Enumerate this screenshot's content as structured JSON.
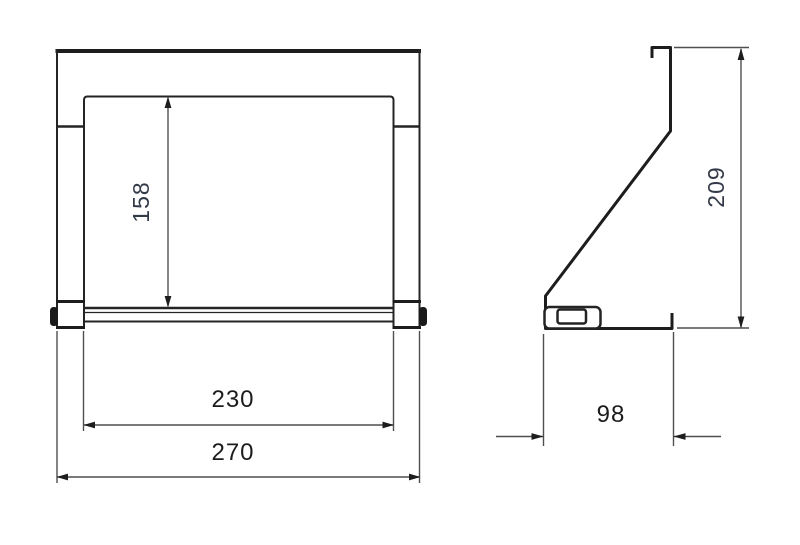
{
  "drawing": {
    "kind": "technical-dimension-drawing",
    "background_color": "#ffffff",
    "part_line_color": "#242424",
    "dimension_line_color": "#4f4f4f",
    "label_color": "#1c1c1c",
    "rotated_label_color": "#333a48",
    "front_view": {
      "name": "front view",
      "dimensions": {
        "opening_height": {
          "value": "158",
          "orientation": "vertical"
        },
        "opening_width": {
          "value": "230",
          "orientation": "horizontal"
        },
        "overall_width": {
          "value": "270",
          "orientation": "horizontal"
        }
      }
    },
    "side_view": {
      "name": "side view",
      "dimensions": {
        "overall_height": {
          "value": "209",
          "orientation": "vertical"
        },
        "base_depth": {
          "value": "98",
          "orientation": "horizontal"
        }
      }
    }
  }
}
